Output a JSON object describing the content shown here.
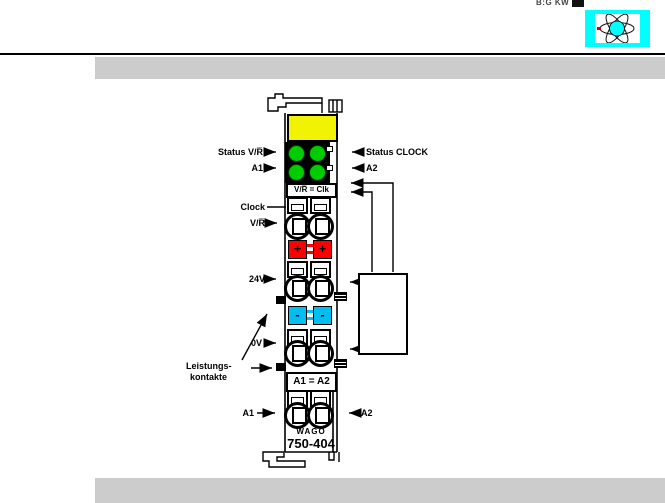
{
  "page": {
    "corner_text": "B:G KW",
    "colors": {
      "logo_cyan": "#00FFFF",
      "bar_gray": "#CCCCCC",
      "led_green": "#00CC00",
      "plus_red": "#FF0000",
      "minus_cyan": "#00BFF0",
      "marking_yellow": "#F2F205"
    }
  },
  "diagram": {
    "left_labels": {
      "status_vr": "Status V/R̅",
      "a1_top": "A1",
      "clock": "Clock",
      "vr": "V/R̅",
      "v24": "24V",
      "v0": "0V",
      "leistung1": "Leistungs-",
      "leistung2": "kontakte",
      "a1_bottom": "A1"
    },
    "right_labels": {
      "status_clock": "Status CLOCK",
      "a2_top": "A2",
      "a2_bottom": "A2"
    },
    "module": {
      "display": "V/R̅ = Clk",
      "plus": "+",
      "minus": "-",
      "relay": "A1 = A2",
      "brand": "WAGO",
      "part": "750-404"
    }
  }
}
